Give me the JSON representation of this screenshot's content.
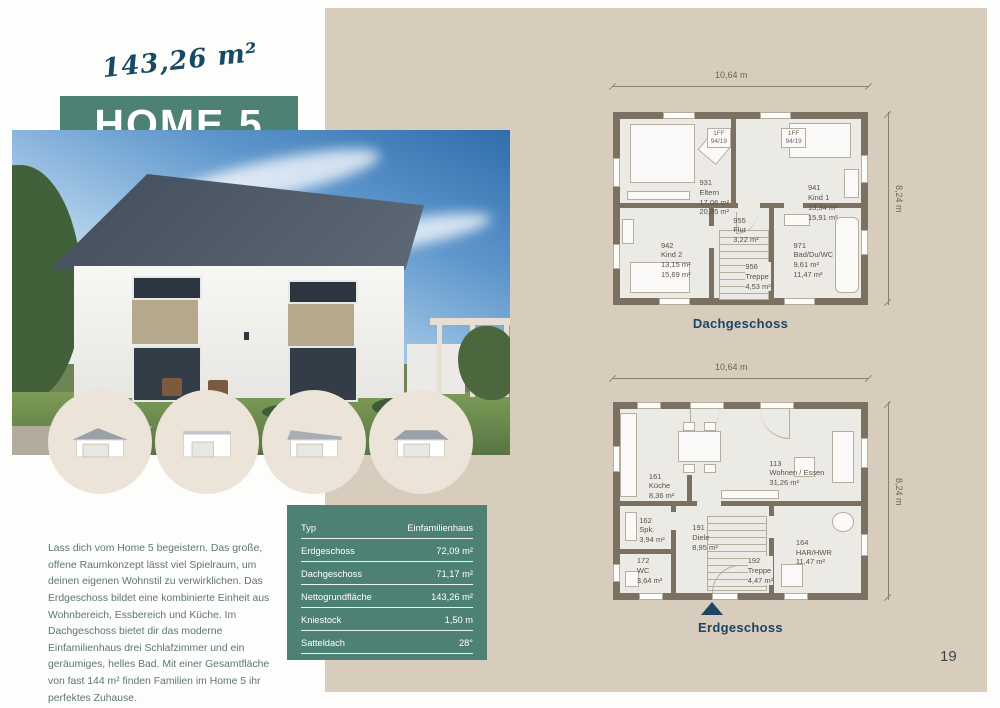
{
  "colors": {
    "accent_teal": "#4d8174",
    "panel_beige": "#d8cdbc",
    "caption_navy": "#1d4365"
  },
  "header": {
    "area_handwritten": "143,26 m²",
    "title": "HOME 5"
  },
  "intro": {
    "text": "Lass dich vom Home 5 begeistern. Das große, offene Raumkonzept lässt viel Spielraum, um deinen eigenen Wohnstil zu verwirklichen. Das Erdgeschoss bildet eine kombinierte Einheit aus Wohnbereich, Essbereich und Küche. Im Dachgeschoss bietet dir das moderne Einfamilienhaus drei Schlafzimmer und ein geräumiges, helles Bad. Mit einer Gesamtfläche von fast 144 m² finden Familien im Home 5 ihr perfektes Zuhause."
  },
  "specs": {
    "rows": [
      {
        "label": "Typ",
        "value": "Einfamilienhaus"
      },
      {
        "label": "Erdgeschoss",
        "value": "72,09 m²"
      },
      {
        "label": "Dachgeschoss",
        "value": "71,17 m²"
      },
      {
        "label": "Nettogrundfläche",
        "value": "143,26 m²"
      },
      {
        "label": "Kniestock",
        "value": "1,50 m"
      },
      {
        "label": "Satteldach",
        "value": "28°"
      }
    ]
  },
  "thumbnails": {
    "variants": [
      "garage-gable-roof",
      "garage-flat-roof",
      "garage-pent-roof",
      "garage-hip-roof"
    ]
  },
  "floorplans": [
    {
      "caption": "Dachgeschoss",
      "width_label": "10,64 m",
      "height_label": "8,24 m",
      "window_labels": [
        "1FF\n94/19",
        "1FF\n94/19"
      ],
      "rooms": [
        {
          "id": "931",
          "name": "Eltern",
          "area1": "17,06 m²",
          "area2": "20,35 m²"
        },
        {
          "id": "941",
          "name": "Kind 1",
          "area1": "13,34 m²",
          "area2": "15,91 m²"
        },
        {
          "id": "942",
          "name": "Kind 2",
          "area1": "13,15 m²",
          "area2": "15,69 m²"
        },
        {
          "id": "955",
          "name": "Flur",
          "area1": "3,22 m²",
          "area2": ""
        },
        {
          "id": "956",
          "name": "Treppe",
          "area1": "4,53 m²",
          "area2": ""
        },
        {
          "id": "971",
          "name": "Bad/Du/WC",
          "area1": "9,61 m²",
          "area2": "11,47 m²"
        }
      ]
    },
    {
      "caption": "Erdgeschoss",
      "width_label": "10,64 m",
      "height_label": "8,24 m",
      "rooms": [
        {
          "id": "113",
          "name": "Wohnen / Essen",
          "area1": "31,26 m²",
          "area2": ""
        },
        {
          "id": "161",
          "name": "Küche",
          "area1": "8,36 m²",
          "area2": ""
        },
        {
          "id": "162",
          "name": "Spk.",
          "area1": "3,94 m²",
          "area2": ""
        },
        {
          "id": "172",
          "name": "WC",
          "area1": "3,64 m²",
          "area2": ""
        },
        {
          "id": "191",
          "name": "Diele",
          "area1": "8,95 m²",
          "area2": ""
        },
        {
          "id": "192",
          "name": "Treppe",
          "area1": "4,47 m²",
          "area2": ""
        },
        {
          "id": "164",
          "name": "HAR/HWR",
          "area1": "11,47 m²",
          "area2": ""
        }
      ]
    }
  ],
  "page": {
    "number": "19"
  }
}
